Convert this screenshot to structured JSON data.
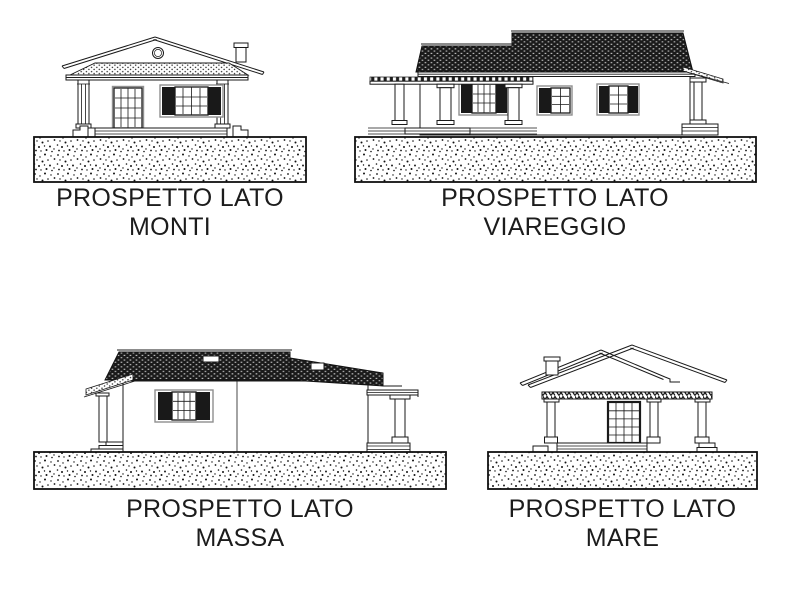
{
  "page": {
    "background": "#ffffff",
    "ink": "#1a1a1a"
  },
  "panels": [
    {
      "id": "monti",
      "caption_line1": "PROSPETTO LATO",
      "caption_line2": "MONTI"
    },
    {
      "id": "viareggio",
      "caption_line1": "PROSPETTO LATO",
      "caption_line2": "VIAREGGIO"
    },
    {
      "id": "massa",
      "caption_line1": "PROSPETTO LATO",
      "caption_line2": "MASSA"
    },
    {
      "id": "mare",
      "caption_line1": "PROSPETTO LATO",
      "caption_line2": "MARE"
    }
  ]
}
